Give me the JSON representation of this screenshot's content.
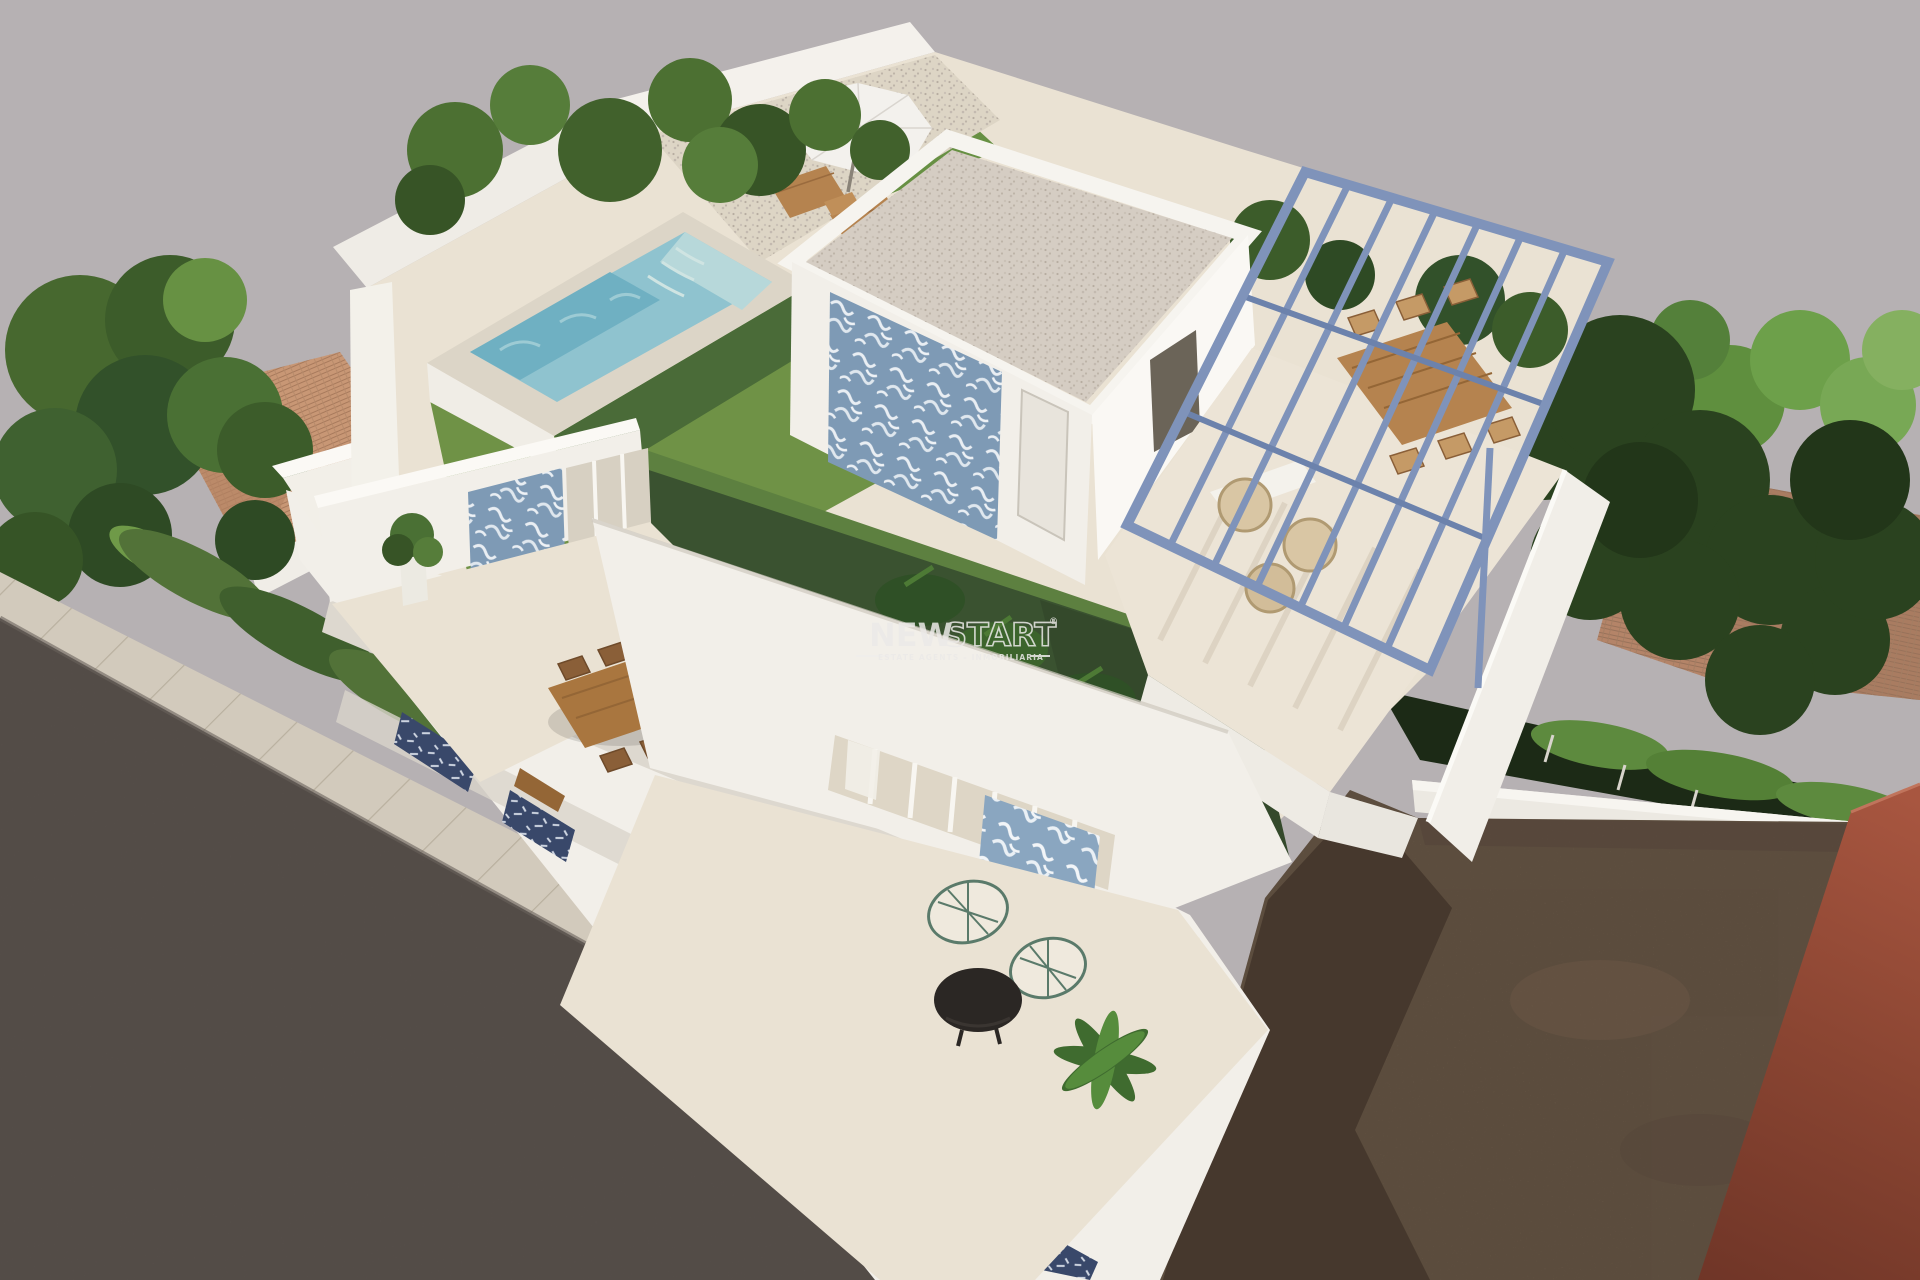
{
  "image": {
    "kind": "3d-architectural-render",
    "description": "Aerial 3D render of a modern two-storey white villa with rooftop pool, artificial lawn, gravel-roof penthouse with blue patterned tile wall, steel-blue pergola over an outdoor dining terrace, lower terraces with outdoor furniture, neighbouring terracotta-roof houses and trees, a vacant dirt lot and red building at right, and street with sidewalk at lower left.",
    "width_px": 1920,
    "height_px": 1280
  },
  "watermark": {
    "brand_part1": "NEW",
    "brand_part2": "START",
    "registered_mark": "®",
    "tagline": "ESTATE AGENTS – INMOBILIARIA"
  },
  "palette": {
    "sky": "#b6b1b3",
    "white_wall": "#f2efe9",
    "white_wall_bright": "#faf8f4",
    "cream_floor": "#eae2d3",
    "lawn": "#6f9246",
    "lawn_shadow": "#3a5230",
    "pool_water": "#8fc3cf",
    "pool_water_deep": "#6fb0c2",
    "pergola_steel": "#7f93ba",
    "tile_pattern_blue": "#7e9ab5",
    "awning_navy": "#39486a",
    "wood": "#b5834f",
    "wood_dark": "#946636",
    "tree_dark": "#2a421f",
    "tree_mid": "#4c7032",
    "tree_light": "#679143",
    "terracotta_roof": "#c89775",
    "terracotta_roof_right": "#b48468",
    "dirt": "#7b6753",
    "dirt_shadow": "#46382d",
    "red_wall": "#8a4532",
    "red_wall_light": "#a85640",
    "road": "#5d5550",
    "sidewalk": "#d2cabc",
    "gravel": "#d5cdc3",
    "watermark_white": "#eceae8"
  }
}
